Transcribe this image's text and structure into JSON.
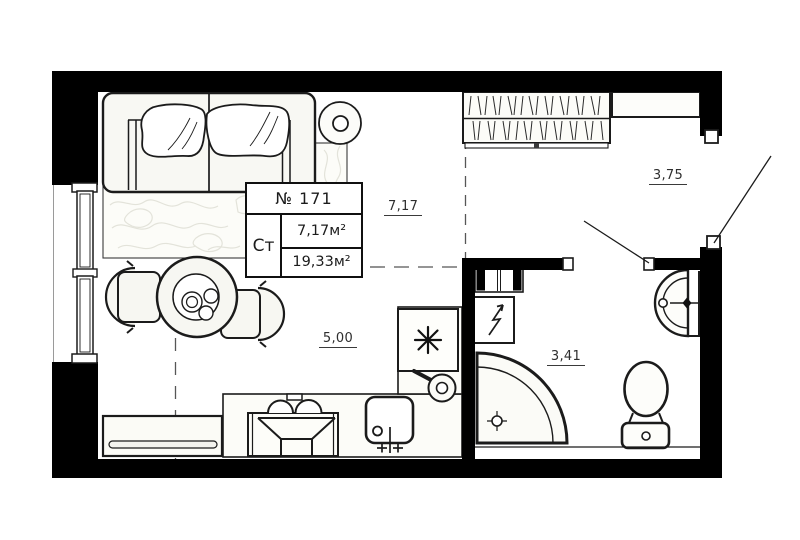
{
  "unit_card": {
    "number": "№ 171",
    "unit_type": "Ст",
    "living_area": "7,17м²",
    "total_area": "19,33м²"
  },
  "dimensions": {
    "living_room": "7,17",
    "hallway": "3,75",
    "kitchen_zone": "5,00",
    "bathroom": "3,41"
  },
  "icons": {
    "fridge": "snowflake-asterisk",
    "water_heater": "lightning-bolt",
    "shower_drain": "crosshair-circle",
    "kitchen_lamp": "frying-pan"
  },
  "colors": {
    "wall_fill": "#000000",
    "outline": "#1b1b1b",
    "furniture_fill": "#f8f8f3",
    "dashed_line": "#565656",
    "rug_pattern": "#e3e3da"
  }
}
